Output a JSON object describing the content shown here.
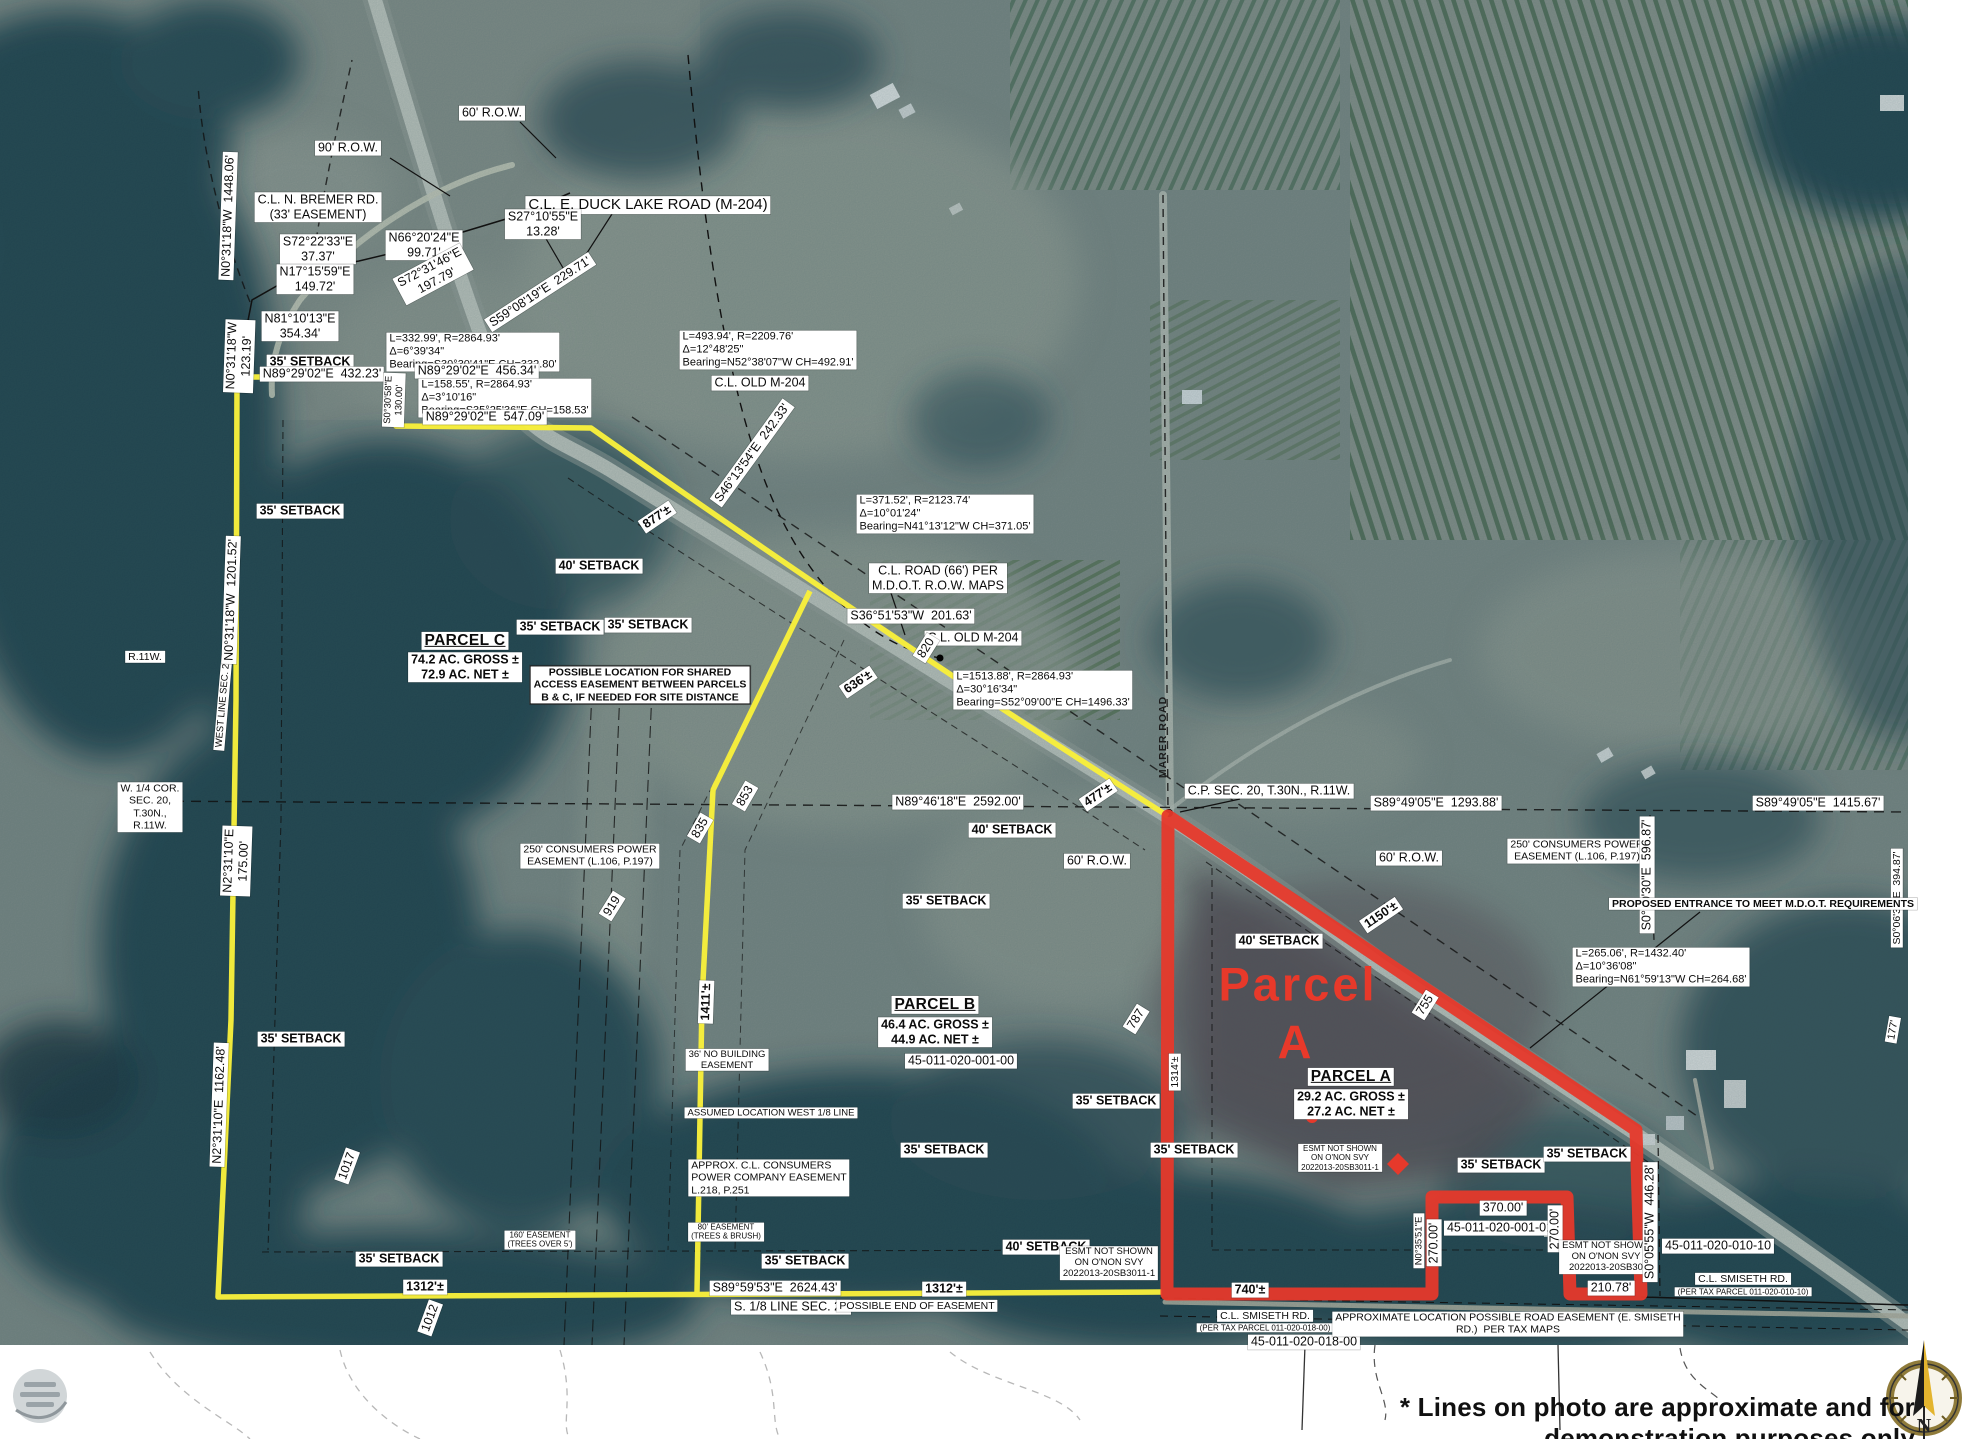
{
  "map": {
    "title_note": "* Lines on photo are approximate and for demonstration purposes only",
    "compass_n": "N",
    "colors": {
      "parcel_a_boundary": "#e6392b",
      "parcel_bc_boundary": "#f8ef3c",
      "label_background": "#ffffff",
      "label_text": "#0b0b0b",
      "parcel_a_big_text": "#e8392a"
    },
    "parcels": [
      {
        "name": "PARCEL A",
        "gross": "29.2 AC. GROSS ±",
        "net": "27.2 AC. NET ±",
        "tax_id": "45-011-020-001-00"
      },
      {
        "name": "PARCEL B",
        "gross": "46.4 AC. GROSS ±",
        "net": "44.9 AC. NET ±"
      },
      {
        "name": "PARCEL C",
        "gross": "74.2 AC. GROSS ±",
        "net": "72.9 AC. NET ±"
      }
    ],
    "labels": [
      {
        "t": "60' R.O.W.",
        "x": 492,
        "y": 113
      },
      {
        "t": "90' R.O.W.",
        "x": 348,
        "y": 148
      },
      {
        "t": "C.L. N. BREMER RD.\n(33' EASEMENT)",
        "x": 318,
        "y": 207
      },
      {
        "t": "C.L. E. DUCK LAKE ROAD (M-204)",
        "x": 648,
        "y": 205,
        "c": "lg"
      },
      {
        "t": "S27°10'55\"E\n13.28'",
        "x": 543,
        "y": 224
      },
      {
        "t": "N66°20'24\"E\n99.71'",
        "x": 424,
        "y": 245
      },
      {
        "t": "S72°22'33\"E\n37.37'",
        "x": 318,
        "y": 249
      },
      {
        "t": "N17°15'59\"E\n149.72'",
        "x": 315,
        "y": 279
      },
      {
        "t": "S72°31'46\"E\n197.79'",
        "x": 433,
        "y": 274,
        "r": -28
      },
      {
        "t": "S59°08'19\"E  229.71'",
        "x": 540,
        "y": 292,
        "r": -33
      },
      {
        "t": "N81°10'13\"E\n354.34'",
        "x": 300,
        "y": 326
      },
      {
        "t": "N0°31'18\"W  1448.06'",
        "x": 228,
        "y": 216,
        "r": -88
      },
      {
        "t": "N0°31'18\"W\n123.19'",
        "x": 239,
        "y": 356,
        "r": -88
      },
      {
        "t": "35' SETBACK",
        "x": 310,
        "y": 362,
        "c": "b"
      },
      {
        "t": "N89°29'02\"E  432.23'",
        "x": 322,
        "y": 374
      },
      {
        "t": "L=332.99', R=2864.93'\nΔ=6°39'34\"\nBearing=S30°30'41\"E CH=332.80'",
        "x": 473,
        "y": 352,
        "c": "curve xs"
      },
      {
        "t": "N89°29'02\"E  456.34'",
        "x": 477,
        "y": 371
      },
      {
        "t": "L=158.55', R=2864.93'\nΔ=3°10'16\"\nBearing=S35°25'36\"E CH=158.53'",
        "x": 505,
        "y": 398,
        "c": "curve xs"
      },
      {
        "t": "N89°29'02\"E  547.09'",
        "x": 485,
        "y": 417
      },
      {
        "t": "S0°30'58\"E\n130.00'",
        "x": 394,
        "y": 400,
        "r": -88,
        "c": "xs"
      },
      {
        "t": "L=493.94', R=2209.76'\nΔ=12°48'25\"\nBearing=N52°38'07\"W CH=492.91'",
        "x": 768,
        "y": 350,
        "c": "curve"
      },
      {
        "t": "C.L. OLD M-204",
        "x": 760,
        "y": 383
      },
      {
        "t": "S46°13'54\"E  242.33'",
        "x": 752,
        "y": 453,
        "r": -54
      },
      {
        "t": "877'±",
        "x": 657,
        "y": 517,
        "r": -34,
        "c": "b"
      },
      {
        "t": "L=371.52', R=2123.74'\nΔ=10°01'24\"\nBearing=N41°13'12\"W CH=371.05'",
        "x": 945,
        "y": 514,
        "c": "curve"
      },
      {
        "t": "C.L. ROAD (66') PER\nM.D.O.T. R.O.W. MAPS",
        "x": 938,
        "y": 578
      },
      {
        "t": "S36°51'53\"W  201.63'",
        "x": 911,
        "y": 616
      },
      {
        "t": "C.L. OLD M-204",
        "x": 973,
        "y": 638
      },
      {
        "t": "820",
        "x": 926,
        "y": 648,
        "r": -58
      },
      {
        "t": "L=1513.88', R=2864.93'\nΔ=30°16'34\"\nBearing=S52°09'00\"E CH=1496.33'",
        "x": 1043,
        "y": 690,
        "c": "curve"
      },
      {
        "t": "636'±",
        "x": 858,
        "y": 682,
        "r": -34,
        "c": "b"
      },
      {
        "t": "PARCEL C",
        "x": 465,
        "y": 641,
        "c": "hdr"
      },
      {
        "t": "74.2 AC. GROSS ±\n72.9 AC. NET ±",
        "x": 465,
        "y": 667,
        "c": "b"
      },
      {
        "t": "POSSIBLE LOCATION FOR SHARED\nACCESS EASEMENT BETWEEN PARCELS\nB & C, IF NEEDED FOR SITE DISTANCE",
        "x": 640,
        "y": 685,
        "c": "b sm boxed"
      },
      {
        "t": "35' SETBACK",
        "x": 300,
        "y": 511,
        "c": "b"
      },
      {
        "t": "40' SETBACK",
        "x": 599,
        "y": 566,
        "c": "b"
      },
      {
        "t": "35' SETBACK",
        "x": 560,
        "y": 627,
        "c": "b"
      },
      {
        "t": "35' SETBACK",
        "x": 648,
        "y": 625,
        "c": "b"
      },
      {
        "t": "N89°46'18\"E  2592.00'",
        "x": 958,
        "y": 802
      },
      {
        "t": "40' SETBACK",
        "x": 1012,
        "y": 830,
        "c": "b"
      },
      {
        "t": "60' R.O.W.",
        "x": 1097,
        "y": 861
      },
      {
        "t": "60' R.O.W.",
        "x": 1409,
        "y": 858
      },
      {
        "t": "C.P. SEC. 20, T.30N., R.11W.",
        "x": 1269,
        "y": 791
      },
      {
        "t": "S89°49'05\"E  1293.88'",
        "x": 1436,
        "y": 803
      },
      {
        "t": "MARER ROAD",
        "x": 1163,
        "y": 737,
        "r": -90,
        "c": "plain sm"
      },
      {
        "t": "477'±",
        "x": 1098,
        "y": 795,
        "r": -34,
        "c": "b"
      },
      {
        "t": "1150'±",
        "x": 1381,
        "y": 915,
        "r": -34,
        "c": "b"
      },
      {
        "t": "40' SETBACK",
        "x": 1279,
        "y": 941,
        "c": "b"
      },
      {
        "t": "250' CONSUMERS POWER\nEASEMENT (L.106, P.197)",
        "x": 1577,
        "y": 851,
        "c": "sm"
      },
      {
        "t": "S89°49'05\"E  1415.67'",
        "x": 1818,
        "y": 803
      },
      {
        "t": "S0°10'30\"E  596.87'",
        "x": 1647,
        "y": 875,
        "r": -90
      },
      {
        "t": "S0°06'30\"E  394.87'",
        "x": 1897,
        "y": 898,
        "r": -90,
        "c": "sm"
      },
      {
        "t": "PROPOSED ENTRANCE TO MEET M.D.O.T. REQUIREMENTS",
        "x": 1763,
        "y": 904,
        "c": "b sm"
      },
      {
        "t": "L=265.06', R=1432.40'\nΔ=10°36'08\"\nBearing=N61°59'13\"W CH=264.68'",
        "x": 1661,
        "y": 967,
        "c": "curve"
      },
      {
        "t": "Parcel",
        "x": 1298,
        "y": 984,
        "c": "red-big"
      },
      {
        "t": "A",
        "x": 1296,
        "y": 1042,
        "c": "red-big"
      },
      {
        "t": "PARCEL A",
        "x": 1351,
        "y": 1077,
        "c": "hdr"
      },
      {
        "t": "29.2 AC. GROSS ±\n27.2 AC. NET ±",
        "x": 1351,
        "y": 1104,
        "c": "b"
      },
      {
        "t": "755",
        "x": 1425,
        "y": 1005,
        "r": -58
      },
      {
        "t": "787",
        "x": 1136,
        "y": 1019,
        "r": -58
      },
      {
        "t": "PARCEL B",
        "x": 935,
        "y": 1005,
        "c": "hdr"
      },
      {
        "t": "46.4 AC. GROSS ±\n44.9 AC. NET ±",
        "x": 935,
        "y": 1032,
        "c": "b"
      },
      {
        "t": "45-011-020-001-00",
        "x": 961,
        "y": 1061
      },
      {
        "t": "1314'±",
        "x": 1175,
        "y": 1072,
        "r": -90,
        "c": "sm"
      },
      {
        "t": "35' SETBACK",
        "x": 946,
        "y": 901,
        "c": "b"
      },
      {
        "t": "35' SETBACK",
        "x": 1116,
        "y": 1101,
        "c": "b"
      },
      {
        "t": "35' SETBACK",
        "x": 944,
        "y": 1150,
        "c": "b"
      },
      {
        "t": "35' SETBACK",
        "x": 1194,
        "y": 1150,
        "c": "b"
      },
      {
        "t": "35' SETBACK",
        "x": 1501,
        "y": 1165,
        "c": "b"
      },
      {
        "t": "35' SETBACK",
        "x": 1587,
        "y": 1154,
        "c": "b"
      },
      {
        "t": "370.00'",
        "x": 1503,
        "y": 1208
      },
      {
        "t": "45-011-020-001-01",
        "x": 1500,
        "y": 1228
      },
      {
        "t": "270.00'",
        "x": 1434,
        "y": 1243,
        "r": -90
      },
      {
        "t": "270.00'",
        "x": 1555,
        "y": 1229,
        "r": -90
      },
      {
        "t": "N0°35'51\"E",
        "x": 1419,
        "y": 1241,
        "r": -90,
        "c": "xs"
      },
      {
        "t": "ESMT NOT SHOWN\nON O'NON SVY\n2022013-20SB30",
        "x": 1606,
        "y": 1257,
        "c": "xs"
      },
      {
        "t": "ESMT NOT SHOWN\nON O'NON SVY\n2022013-20SB3011-1",
        "x": 1340,
        "y": 1158,
        "c": "xxs"
      },
      {
        "t": "S0°05'55\"W  446.28'",
        "x": 1650,
        "y": 1222,
        "r": -90
      },
      {
        "t": "45-011-020-010-10",
        "x": 1718,
        "y": 1246
      },
      {
        "t": "C.L. SMISETH RD.",
        "x": 1743,
        "y": 1279,
        "c": "sm"
      },
      {
        "t": "(PER TAX PARCEL 011-020-010-10)",
        "x": 1743,
        "y": 1292,
        "c": "xxs"
      },
      {
        "t": "210.78'",
        "x": 1611,
        "y": 1288
      },
      {
        "t": "740'±",
        "x": 1250,
        "y": 1290,
        "c": "b"
      },
      {
        "t": "C.L. SMISETH RD.",
        "x": 1265,
        "y": 1316,
        "c": "sm"
      },
      {
        "t": "(PER TAX PARCEL 011-020-018-00)",
        "x": 1265,
        "y": 1328,
        "c": "xxs"
      },
      {
        "t": "45-011-020-018-00",
        "x": 1304,
        "y": 1342
      },
      {
        "t": "APPROXIMATE LOCATION POSSIBLE ROAD EASEMENT (E. SMISETH\nRD.)  PER TAX MAPS",
        "x": 1508,
        "y": 1324,
        "c": "sm"
      },
      {
        "t": "40' SETBACK",
        "x": 1046,
        "y": 1247,
        "c": "b"
      },
      {
        "t": "ESMT NOT SHOWN\nON O'NON SVY\n2022013-20SB3011-1",
        "x": 1109,
        "y": 1263,
        "c": "xs"
      },
      {
        "t": "35' SETBACK",
        "x": 805,
        "y": 1261,
        "c": "b"
      },
      {
        "t": "S89°59'53\"E  2624.43'",
        "x": 775,
        "y": 1288
      },
      {
        "t": "1312'±",
        "x": 944,
        "y": 1289,
        "c": "b"
      },
      {
        "t": "S. 1/8 LINE SEC. 20",
        "x": 791,
        "y": 1307
      },
      {
        "t": "POSSIBLE END OF EASEMENT",
        "x": 917,
        "y": 1306,
        "c": "sm"
      },
      {
        "t": "1312'±",
        "x": 425,
        "y": 1287,
        "c": "b"
      },
      {
        "t": "35' SETBACK",
        "x": 399,
        "y": 1259,
        "c": "b"
      },
      {
        "t": "35' SETBACK",
        "x": 301,
        "y": 1039,
        "c": "b"
      },
      {
        "t": "1017",
        "x": 347,
        "y": 1166,
        "r": -70
      },
      {
        "t": "1012",
        "x": 430,
        "y": 1318,
        "r": -70
      },
      {
        "t": "N2°31'10\"E  1162.48'",
        "x": 219,
        "y": 1105,
        "r": -88
      },
      {
        "t": "N2°31'10\"E\n175.00'",
        "x": 236,
        "y": 861,
        "r": -88
      },
      {
        "t": "WEST LINE SEC. 20",
        "x": 223,
        "y": 703,
        "r": -85,
        "c": "xs"
      },
      {
        "t": "N0°31'18\"W  1201.52'",
        "x": 231,
        "y": 600,
        "r": -88
      },
      {
        "t": "W. 1/4 COR.\nSEC. 20,\nT.30N.,\nR.11W.",
        "x": 150,
        "y": 807,
        "c": "sm"
      },
      {
        "t": "R.11W.",
        "x": 145,
        "y": 657,
        "c": "sm"
      },
      {
        "t": "250' CONSUMERS POWER\nEASEMENT (L.106, P.197)",
        "x": 590,
        "y": 856,
        "c": "sm"
      },
      {
        "t": "919",
        "x": 612,
        "y": 906,
        "r": -58
      },
      {
        "t": "1411'±",
        "x": 706,
        "y": 1002,
        "r": -88,
        "c": "b"
      },
      {
        "t": "36' NO BUILDING\nEASEMENT",
        "x": 727,
        "y": 1060,
        "c": "xs"
      },
      {
        "t": "ASSUMED LOCATION WEST 1/8 LINE",
        "x": 771,
        "y": 1113,
        "c": "xs"
      },
      {
        "t": "APPROX. C.L. CONSUMERS\nPOWER COMPANY EASEMENT\nL.218, P.251",
        "x": 769,
        "y": 1178,
        "c": "sm left"
      },
      {
        "t": "80' EASEMENT\n(TREES & BRUSH)",
        "x": 726,
        "y": 1232,
        "c": "xxs"
      },
      {
        "t": "160' EASEMENT\n(TREES OVER 5')",
        "x": 540,
        "y": 1240,
        "c": "xxs"
      },
      {
        "t": "853",
        "x": 745,
        "y": 796,
        "r": -60
      },
      {
        "t": "835",
        "x": 700,
        "y": 828,
        "r": -60
      },
      {
        "t": "177'",
        "x": 1893,
        "y": 1030,
        "r": -80,
        "c": "sm"
      }
    ]
  }
}
